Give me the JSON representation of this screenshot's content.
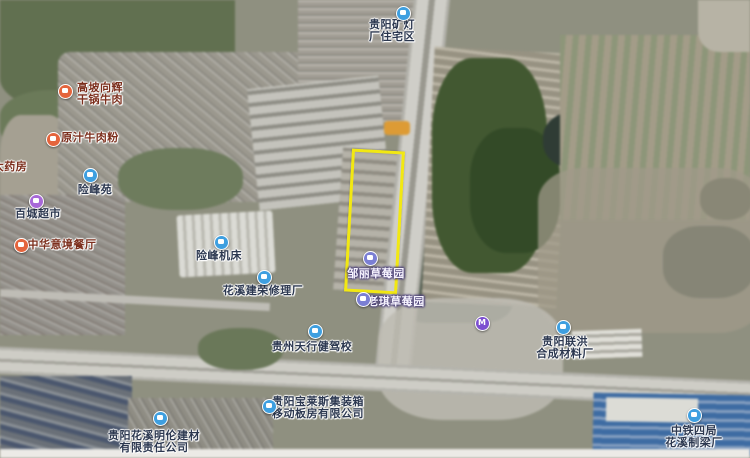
{
  "map": {
    "type": "satellite-map",
    "highlight": {
      "x": 348,
      "y": 150,
      "width": 47,
      "height": 137,
      "rotation_deg": 3.2,
      "color": "#f2e812"
    },
    "icon_colors": {
      "business": "#3e9fe0",
      "food": "#e4643c",
      "shopping": "#a868d8",
      "farm": "#7b7fd4",
      "transit": "#7c4fd0"
    },
    "pois": [
      {
        "id": "kuangdeng-residence",
        "lines": [
          "贵阳矿灯",
          "厂住宅区"
        ],
        "category": "business",
        "style": "dark",
        "icon": {
          "x": 403,
          "y": 13
        },
        "label": {
          "x": 392,
          "y": 19
        }
      },
      {
        "id": "gaopo-dry-pot-beef",
        "lines": [
          "高坡向辉",
          "干锅牛肉"
        ],
        "category": "food",
        "style": "maroon",
        "icon": {
          "x": 65,
          "y": 91
        },
        "label": {
          "x": 100,
          "y": 82
        }
      },
      {
        "id": "yuanzhi-beef-noodles",
        "lines": [
          "原汁牛肉粉"
        ],
        "category": "food",
        "style": "maroon",
        "icon": {
          "x": 53,
          "y": 139
        },
        "label": {
          "x": 90,
          "y": 132
        }
      },
      {
        "id": "pharmacy",
        "lines": [
          "大药房"
        ],
        "category": "food",
        "style": "maroon",
        "icon": null,
        "label": {
          "x": 10,
          "y": 161
        }
      },
      {
        "id": "xianfeng-yuan",
        "lines": [
          "险峰苑"
        ],
        "category": "business",
        "style": "dark",
        "icon": {
          "x": 90,
          "y": 175
        },
        "label": {
          "x": 95,
          "y": 184
        }
      },
      {
        "id": "baicheng-supermarket",
        "lines": [
          "百城超市"
        ],
        "category": "shopping",
        "style": "dark",
        "icon": {
          "x": 36,
          "y": 201
        },
        "label": {
          "x": 38,
          "y": 208
        }
      },
      {
        "id": "zhonghua-restaurant",
        "lines": [
          "中华意境餐厅"
        ],
        "category": "food",
        "style": "maroon",
        "icon": {
          "x": 21,
          "y": 245
        },
        "label": {
          "x": 62,
          "y": 239
        }
      },
      {
        "id": "xianfeng-machine-tools",
        "lines": [
          "险峰机床"
        ],
        "category": "business",
        "style": "dark",
        "icon": {
          "x": 221,
          "y": 242
        },
        "label": {
          "x": 219,
          "y": 250
        }
      },
      {
        "id": "huaxi-jianrong-repair",
        "lines": [
          "花溪建荣修理厂"
        ],
        "category": "business",
        "style": "dark",
        "icon": {
          "x": 264,
          "y": 277
        },
        "label": {
          "x": 263,
          "y": 285
        }
      },
      {
        "id": "zouli-strawberry-farm",
        "lines": [
          "邹丽草莓园"
        ],
        "category": "farm",
        "style": "light",
        "icon": {
          "x": 370,
          "y": 258
        },
        "label": {
          "x": 376,
          "y": 268
        }
      },
      {
        "id": "laoqi-strawberry-farm",
        "lines": [
          "老琪草莓园"
        ],
        "category": "farm",
        "style": "light",
        "icon": {
          "x": 363,
          "y": 299
        },
        "label": {
          "x": 396,
          "y": 296
        }
      },
      {
        "id": "metro-station",
        "lines": [],
        "glyph": "M",
        "category": "transit",
        "style": "dark",
        "icon": {
          "x": 482,
          "y": 323
        },
        "label": null
      },
      {
        "id": "lianhong-materials-factory",
        "lines": [
          "贵阳联洪",
          "合成材料厂"
        ],
        "category": "business",
        "style": "dark",
        "icon": {
          "x": 563,
          "y": 327
        },
        "label": {
          "x": 565,
          "y": 336
        }
      },
      {
        "id": "tianxingjian-driving-school",
        "lines": [
          "贵州天行健驾校"
        ],
        "category": "business",
        "style": "dark",
        "icon": {
          "x": 315,
          "y": 331
        },
        "label": {
          "x": 312,
          "y": 341
        }
      },
      {
        "id": "baolai-container-housing",
        "lines": [
          "贵阳宝莱斯集装箱",
          "移动板房有限公司"
        ],
        "category": "business",
        "style": "dark",
        "icon": {
          "x": 269,
          "y": 406
        },
        "label": {
          "x": 318,
          "y": 396
        }
      },
      {
        "id": "minglun-building-materials",
        "lines": [
          "贵阳花溪明伦建材",
          "有限责任公司"
        ],
        "category": "business",
        "style": "dark",
        "icon": {
          "x": 160,
          "y": 418
        },
        "label": {
          "x": 154,
          "y": 430
        }
      },
      {
        "id": "zhongtie-beam-factory",
        "lines": [
          "中铁四局",
          "花溪制梁厂"
        ],
        "category": "business",
        "style": "dark",
        "icon": {
          "x": 694,
          "y": 415
        },
        "label": {
          "x": 694,
          "y": 425
        }
      }
    ]
  }
}
